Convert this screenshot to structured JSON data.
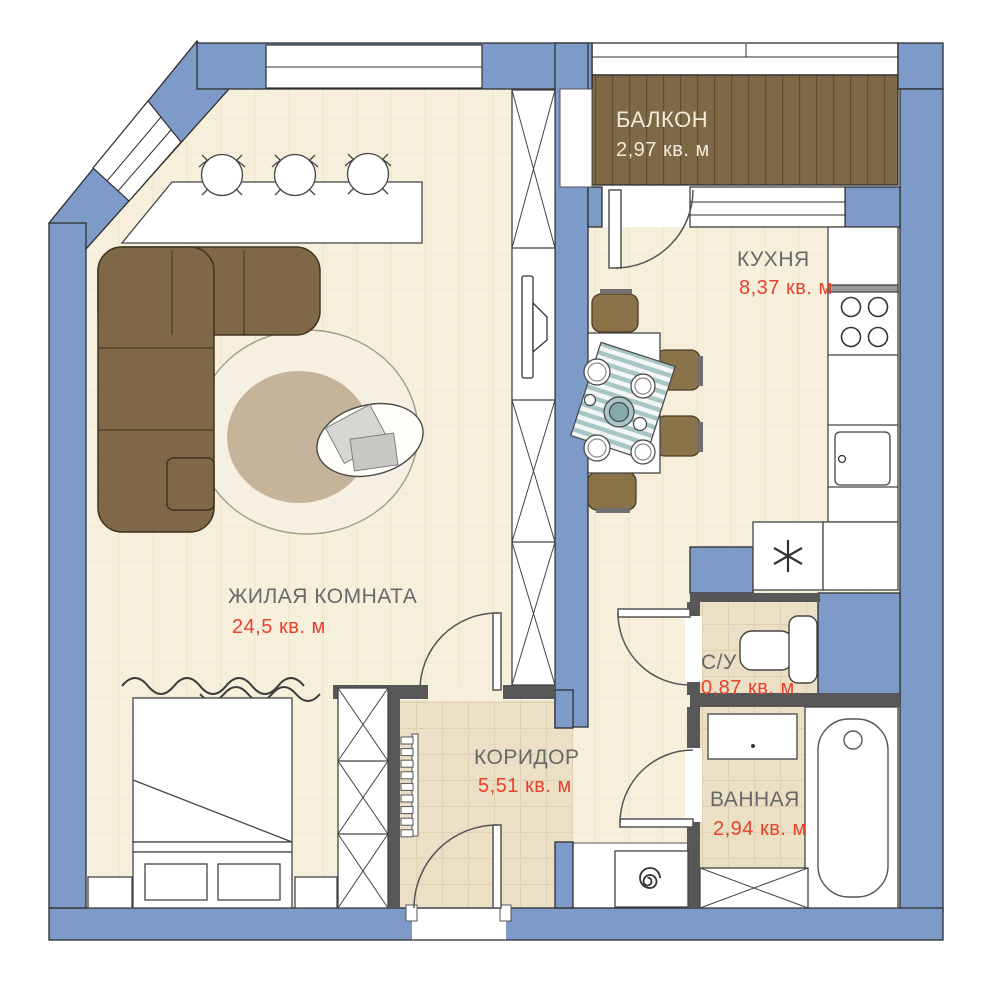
{
  "plan": {
    "type": "apartment-floor-plan",
    "colors": {
      "wall_blue": "#7d9ac9",
      "wall_dark": "#575757",
      "outline": "#2e2e2e",
      "floor_main": "#f6efdc",
      "floor_tile": "#ebe0c5",
      "balcony_wood": "#7e6947",
      "furniture_brown": "#7f6848",
      "room_label": "#686868",
      "area_label": "#e8412c",
      "accent_teal": "#a9c6c6"
    },
    "rooms": [
      {
        "name": "ЖИЛАЯ КОМНАТА",
        "area": "24,5 кв. м"
      },
      {
        "name": "КУХНЯ",
        "area": "8,37 кв. м"
      },
      {
        "name": "БАЛКОН",
        "area": "2,97 кв. м"
      },
      {
        "name": "КОРИДОР",
        "area": "5,51 кв. м"
      },
      {
        "name": "С/У",
        "area": "0,87 кв. м"
      },
      {
        "name": "ВАННАЯ",
        "area": "2,94 кв. м"
      }
    ],
    "furniture": [
      "corner-sofa",
      "round-rug",
      "coffee-table",
      "bar-counter",
      "bar-stools",
      "wall-tv",
      "wardrobes",
      "double-bed",
      "nightstands",
      "curtain",
      "hallway-radiator",
      "dining-table",
      "dining-chairs",
      "table-setting",
      "stove",
      "kitchen-sink",
      "fridge",
      "toilet",
      "washbasin",
      "bathtub",
      "washing-machine",
      "bathroom-cabinet"
    ]
  }
}
